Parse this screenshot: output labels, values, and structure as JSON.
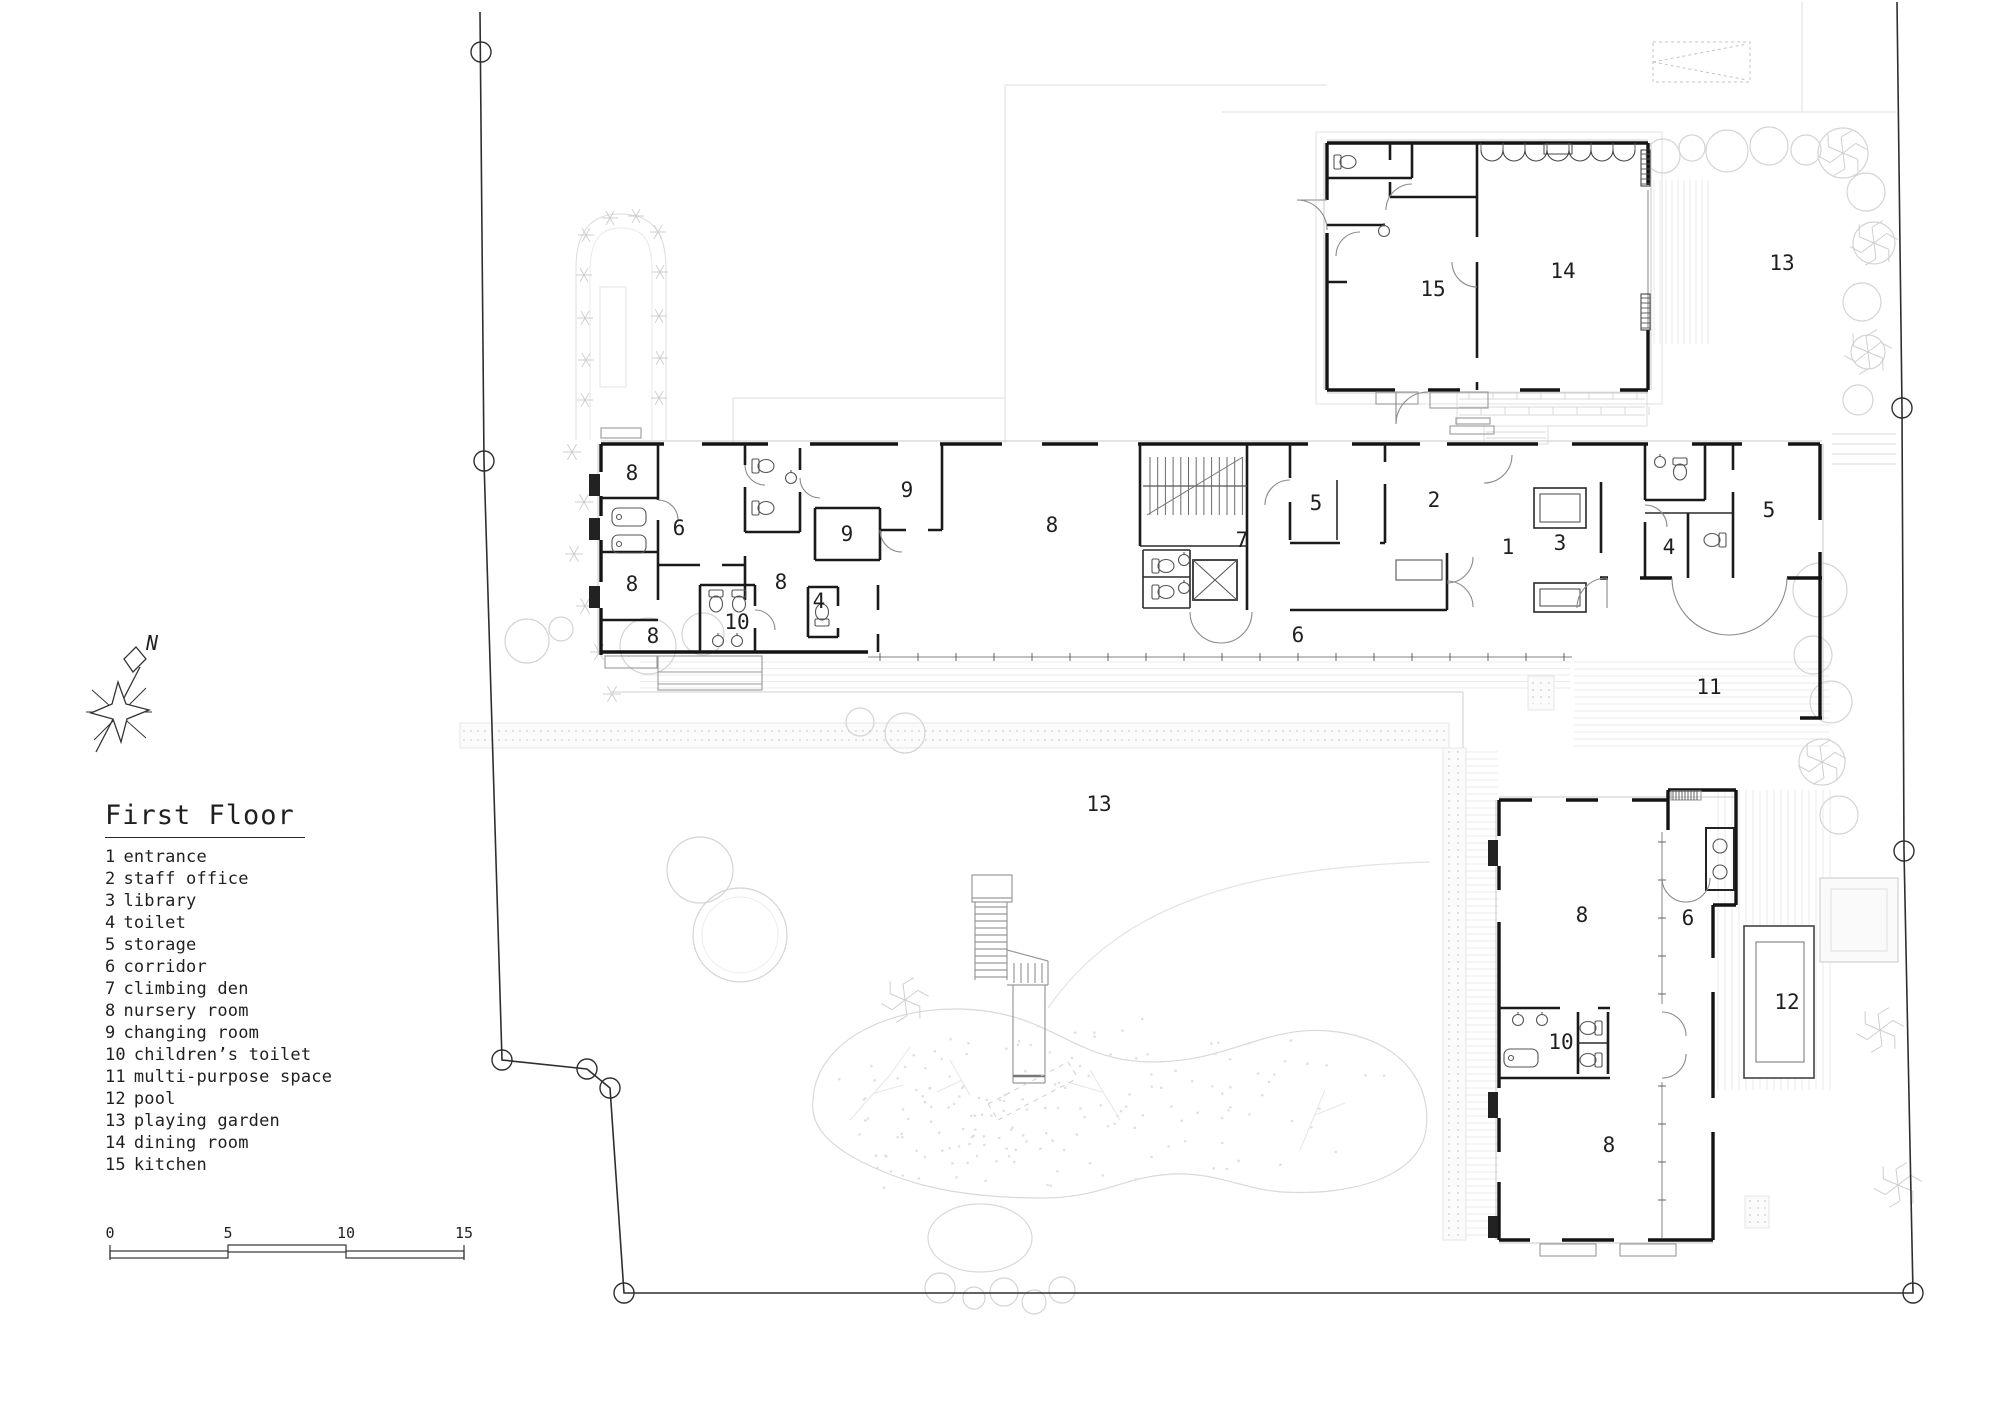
{
  "title": {
    "text": "First Floor"
  },
  "legend": {
    "items": [
      {
        "num": "1",
        "label": "entrance"
      },
      {
        "num": "2",
        "label": "staff office"
      },
      {
        "num": "3",
        "label": "library"
      },
      {
        "num": "4",
        "label": "toilet"
      },
      {
        "num": "5",
        "label": "storage"
      },
      {
        "num": "6",
        "label": "corridor"
      },
      {
        "num": "7",
        "label": "climbing den"
      },
      {
        "num": "8",
        "label": "nursery room"
      },
      {
        "num": "9",
        "label": "changing room"
      },
      {
        "num": "10",
        "label": "children’s toilet"
      },
      {
        "num": "11",
        "label": "multi-purpose space"
      },
      {
        "num": "12",
        "label": "pool"
      },
      {
        "num": "13",
        "label": "playing garden"
      },
      {
        "num": "14",
        "label": "dining room"
      },
      {
        "num": "15",
        "label": "kitchen"
      }
    ]
  },
  "compass": {
    "label": "N"
  },
  "scale_bar": {
    "ticks": [
      "0",
      "5",
      "10",
      "15"
    ]
  },
  "plan": {
    "room_labels": [
      {
        "text": "8",
        "x": 632,
        "y": 473
      },
      {
        "text": "6",
        "x": 679,
        "y": 528
      },
      {
        "text": "8",
        "x": 632,
        "y": 584
      },
      {
        "text": "8",
        "x": 653,
        "y": 636
      },
      {
        "text": "10",
        "x": 737,
        "y": 622
      },
      {
        "text": "8",
        "x": 781,
        "y": 582
      },
      {
        "text": "4",
        "x": 819,
        "y": 601
      },
      {
        "text": "9",
        "x": 847,
        "y": 534
      },
      {
        "text": "9",
        "x": 907,
        "y": 490
      },
      {
        "text": "8",
        "x": 1052,
        "y": 525
      },
      {
        "text": "7",
        "x": 1242,
        "y": 540
      },
      {
        "text": "5",
        "x": 1316,
        "y": 503
      },
      {
        "text": "2",
        "x": 1434,
        "y": 500
      },
      {
        "text": "1",
        "x": 1508,
        "y": 547
      },
      {
        "text": "6",
        "x": 1298,
        "y": 635
      },
      {
        "text": "3",
        "x": 1560,
        "y": 543
      },
      {
        "text": "4",
        "x": 1669,
        "y": 547
      },
      {
        "text": "5",
        "x": 1769,
        "y": 510
      },
      {
        "text": "11",
        "x": 1709,
        "y": 687
      },
      {
        "text": "15",
        "x": 1433,
        "y": 289
      },
      {
        "text": "14",
        "x": 1563,
        "y": 271
      },
      {
        "text": "13",
        "x": 1782,
        "y": 263
      },
      {
        "text": "13",
        "x": 1099,
        "y": 804
      },
      {
        "text": "8",
        "x": 1582,
        "y": 915
      },
      {
        "text": "6",
        "x": 1688,
        "y": 918
      },
      {
        "text": "12",
        "x": 1787,
        "y": 1002
      },
      {
        "text": "10",
        "x": 1561,
        "y": 1042
      },
      {
        "text": "8",
        "x": 1609,
        "y": 1145
      }
    ]
  },
  "colors": {
    "wall_ink": "#141414",
    "boundary_ink": "#2e2e2e",
    "text_ink": "#1f1f1f",
    "light_line": "#dedede"
  }
}
